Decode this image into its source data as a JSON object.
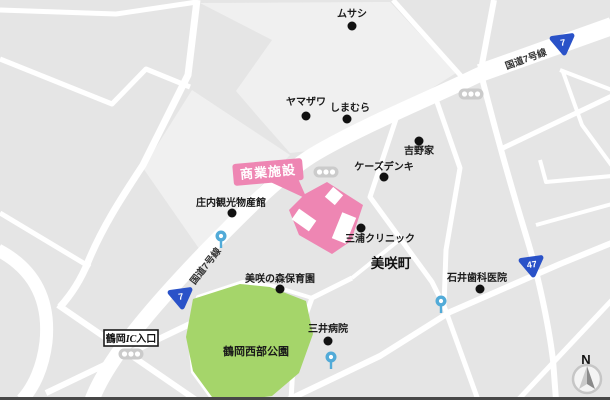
{
  "map": {
    "town_label": "美咲町",
    "park_label": "鶴岡西部公園",
    "facility_label": "商業施設",
    "ic_label_prefix": "鶴岡",
    "ic_label_mid": "IC",
    "ic_label_suffix": "入口",
    "compass_label": "N",
    "route7_label_upper": "国道7号線",
    "route7_label_lower": "国道7号線",
    "colors": {
      "facility_pink": "#ee86b3",
      "park_green": "#a5d56a",
      "shield_blue": "#2a52c8",
      "bus_stop_blue": "#52abd8",
      "road_white": "#ffffff",
      "block_gray": "#e5e5e5",
      "block_light_gray": "#f0f0f0"
    },
    "pois": [
      {
        "name": "ムサシ",
        "x": 352,
        "y": 26,
        "label_x": 352,
        "label_y": 17,
        "anchor": "middle"
      },
      {
        "name": "ヤマザワ",
        "x": 306,
        "y": 116,
        "label_x": 306,
        "label_y": 105,
        "anchor": "middle"
      },
      {
        "name": "しまむら",
        "x": 347,
        "y": 119,
        "label_x": 350,
        "label_y": 111,
        "anchor": "middle"
      },
      {
        "name": "吉野家",
        "x": 419,
        "y": 141,
        "label_x": 419,
        "label_y": 154,
        "anchor": "middle"
      },
      {
        "name": "ケーズデンキ",
        "x": 384,
        "y": 177,
        "label_x": 384,
        "label_y": 170,
        "anchor": "middle"
      },
      {
        "name": "庄内観光物産館",
        "x": 232,
        "y": 213,
        "label_x": 231,
        "label_y": 206,
        "anchor": "middle"
      },
      {
        "name": "三浦クリニック",
        "x": 361,
        "y": 228,
        "label_x": 345,
        "label_y": 242,
        "anchor": "start"
      },
      {
        "name": "美咲の森保育園",
        "x": 280,
        "y": 289,
        "label_x": 280,
        "label_y": 282,
        "anchor": "middle"
      },
      {
        "name": "石井歯科医院",
        "x": 480,
        "y": 289,
        "label_x": 477,
        "label_y": 281,
        "anchor": "middle"
      },
      {
        "name": "三井病院",
        "x": 328,
        "y": 341,
        "label_x": 328,
        "label_y": 332,
        "anchor": "middle"
      }
    ],
    "route_shields": [
      {
        "num": "7",
        "x": 563,
        "y": 44
      },
      {
        "num": "7",
        "x": 181,
        "y": 298
      },
      {
        "num": "47",
        "x": 532,
        "y": 266
      }
    ],
    "traffic_lights": [
      {
        "x": 471,
        "y": 94
      },
      {
        "x": 326,
        "y": 172
      },
      {
        "x": 131,
        "y": 354
      }
    ],
    "bus_stops": [
      {
        "x": 221,
        "y": 236
      },
      {
        "x": 441,
        "y": 301
      },
      {
        "x": 331,
        "y": 357
      }
    ]
  }
}
